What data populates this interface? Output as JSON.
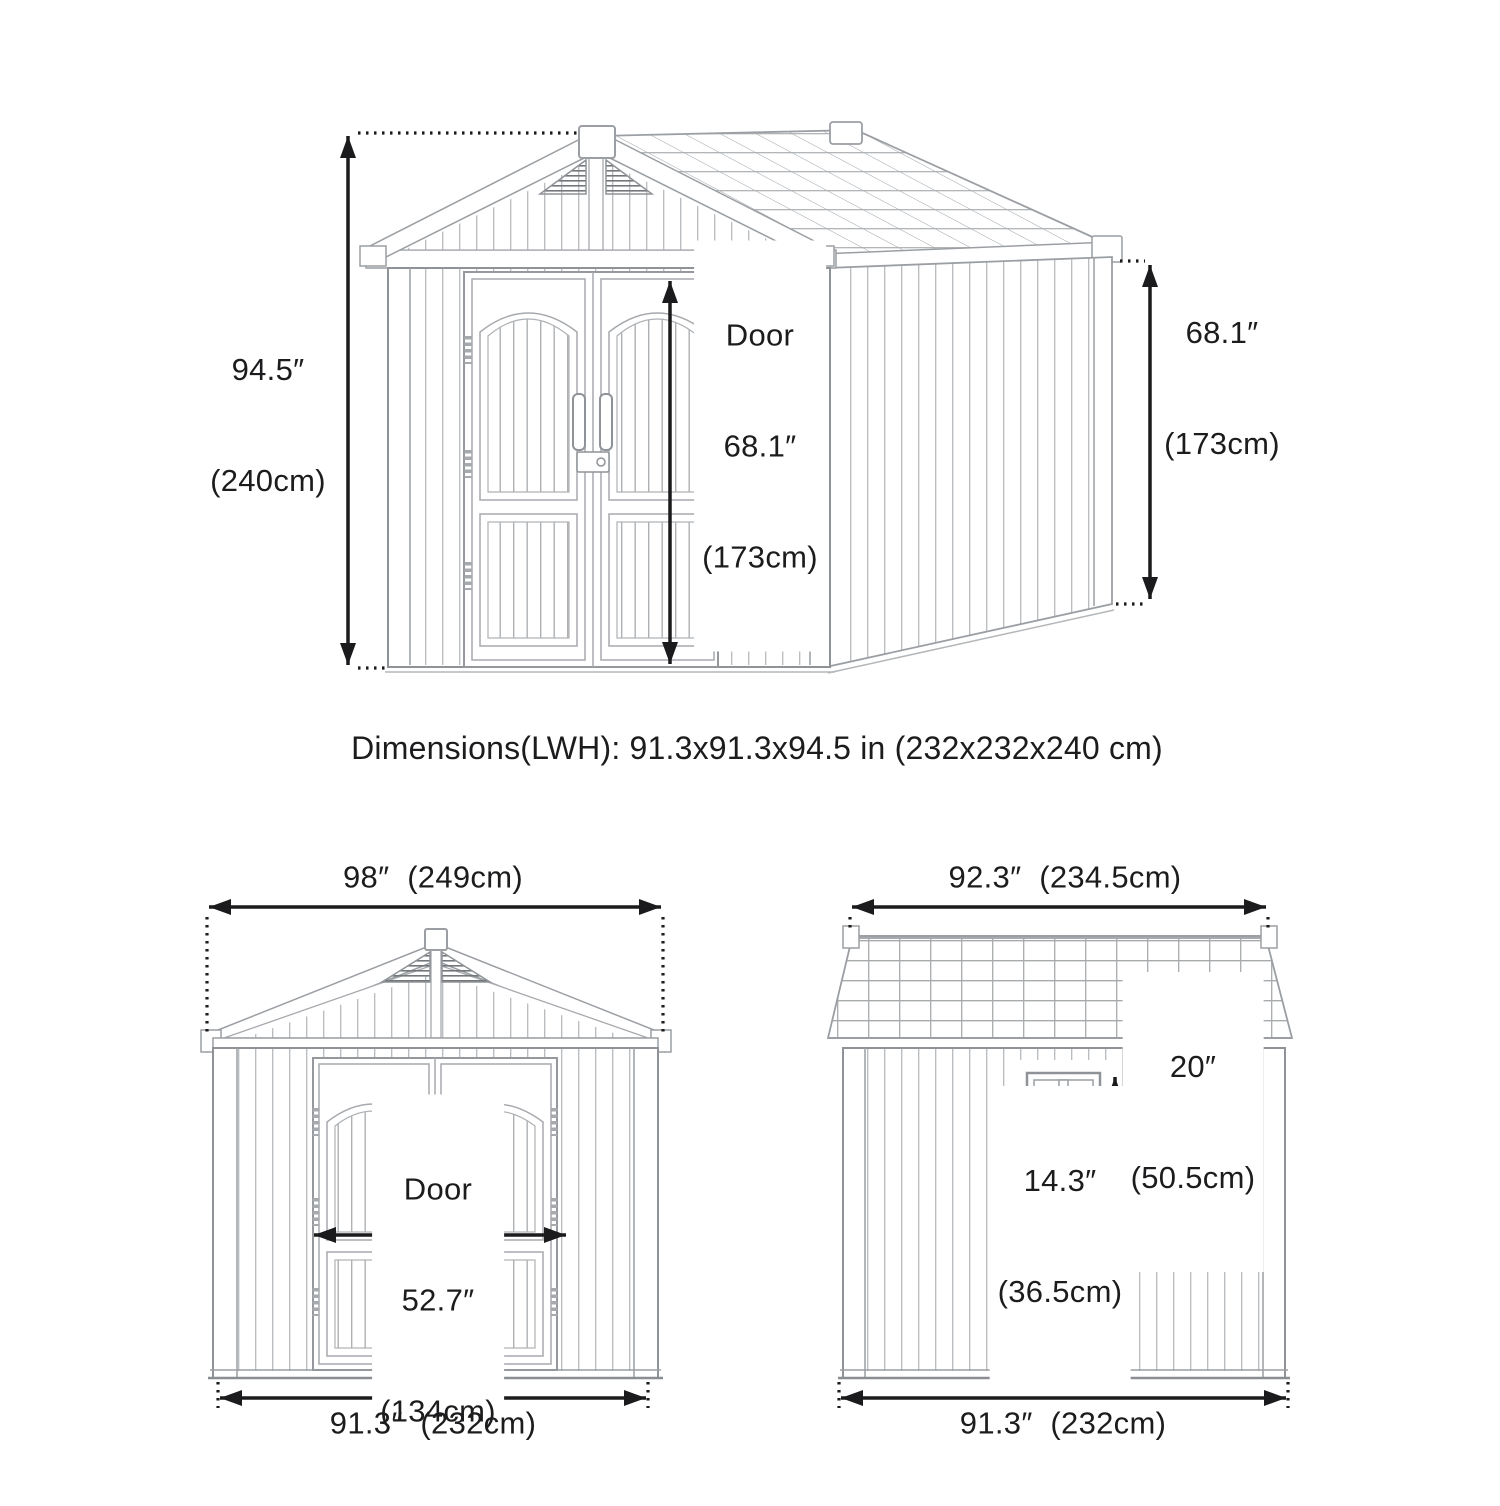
{
  "title": "Storage shed dimension diagram",
  "summary": "Dimensions(LWH): 91.3x91.3x94.5 in (232x232x240 cm)",
  "perspective_view": {
    "height_label": {
      "value": "94.5″",
      "metric": "(240cm)"
    },
    "door_label": {
      "name": "Door",
      "value": "68.1″",
      "metric": "(173cm)"
    },
    "side_height_label": {
      "value": "68.1″",
      "metric": "(173cm)"
    }
  },
  "front_view": {
    "overall_width_label": "98″  (249cm)",
    "door_label": {
      "name": "Door",
      "value": "52.7″",
      "metric": "(134cm)"
    },
    "base_width_label": "91.3″  (232cm)"
  },
  "side_view": {
    "overall_width_label": "92.3″  (234.5cm)",
    "window_height_label": {
      "value": "20″",
      "metric": "(50.5cm)"
    },
    "window_width_label": {
      "value": "14.3″",
      "metric": "(36.5cm)"
    },
    "base_width_label": "91.3″  (232cm)"
  }
}
